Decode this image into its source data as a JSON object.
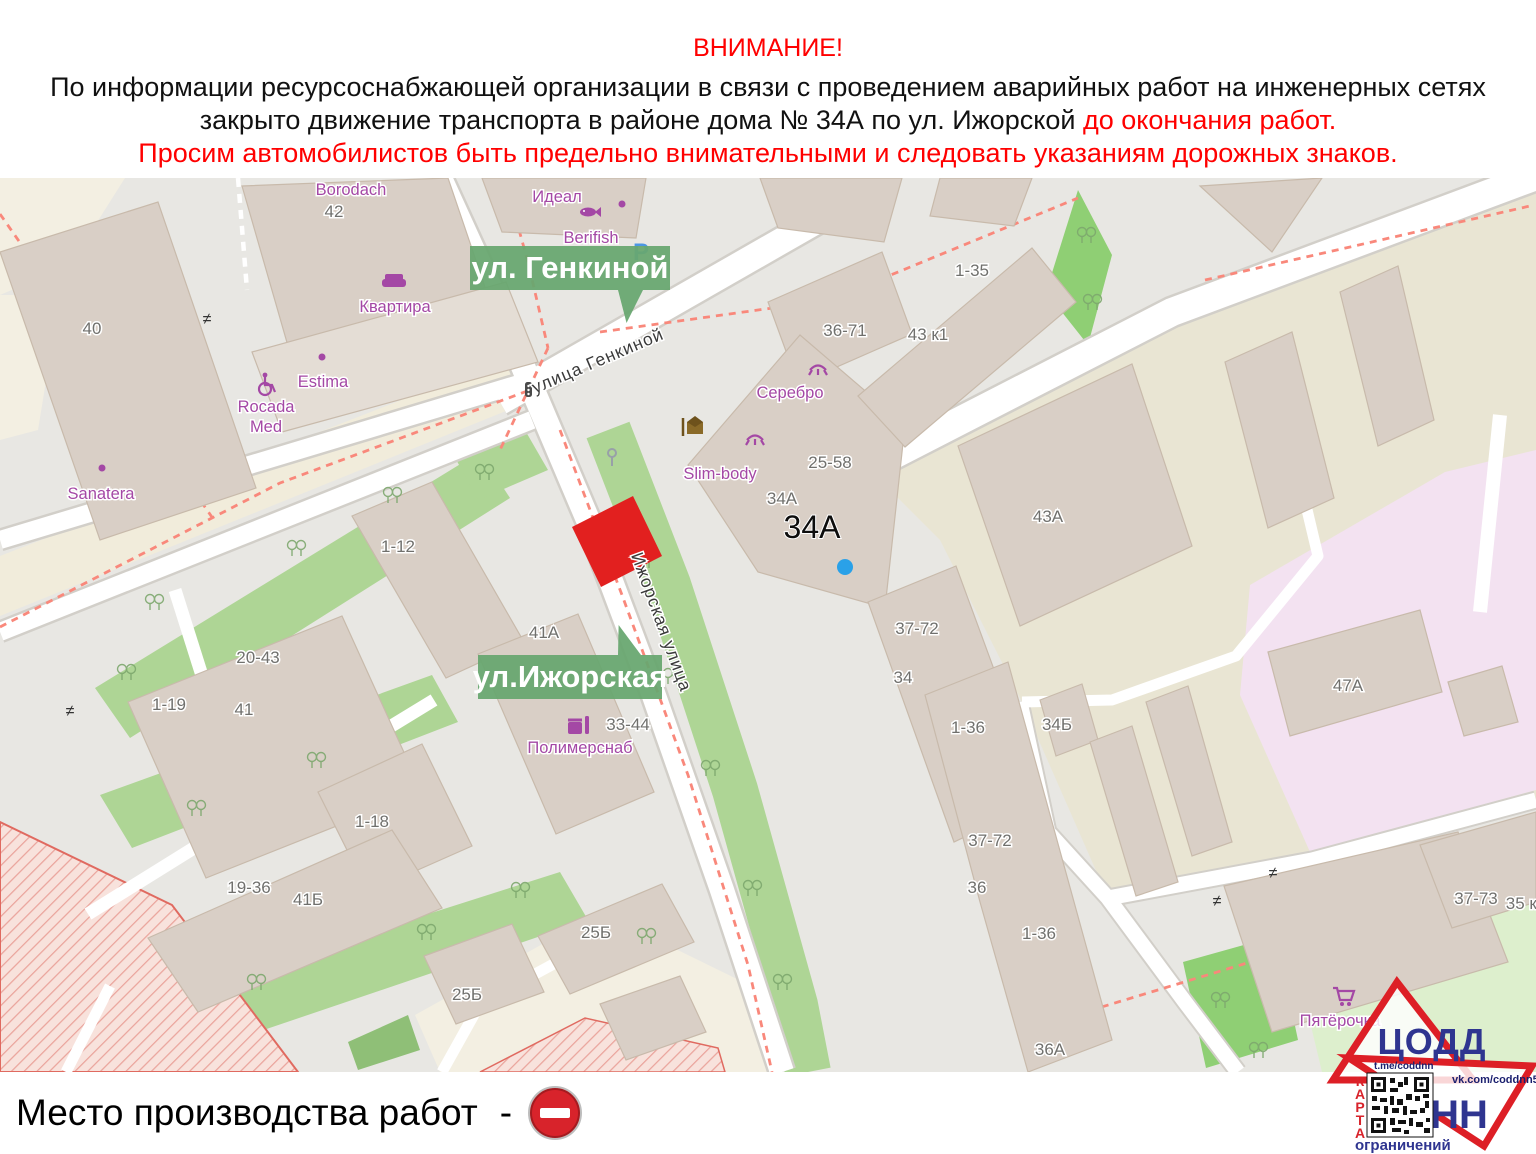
{
  "header": {
    "title": "ВНИМАНИЕ!",
    "line1": "По информации ресурсоснабжающей организации в связи с проведением аварийных работ на инженерных сетях",
    "line2_black": "закрыто движение транспорта в районе дома № 34А по ул. Ижорской",
    "line2_red": "до окончания работ.",
    "line3": "Просим автомобилистов быть предельно внимательными и следовать указаниям дорожных знаков."
  },
  "map": {
    "badges": [
      {
        "label": "ул. Генкиной"
      },
      {
        "label": "ул.Ижорская"
      }
    ],
    "street_labels": [
      {
        "text": "улица Генкиной",
        "x": 600,
        "y": 366,
        "rot": -23
      },
      {
        "text": "Ижорская улица",
        "x": 656,
        "y": 624,
        "rot": 70
      }
    ],
    "highlight": {
      "text": "34А",
      "x": 812,
      "y": 538
    },
    "house_numbers": [
      {
        "t": "40",
        "x": 92,
        "y": 334
      },
      {
        "t": "42",
        "x": 334,
        "y": 217
      },
      {
        "t": "1-35",
        "x": 972,
        "y": 276
      },
      {
        "t": "36-71",
        "x": 845,
        "y": 336
      },
      {
        "t": "43 к1",
        "x": 928,
        "y": 340
      },
      {
        "t": "25-58",
        "x": 830,
        "y": 468
      },
      {
        "t": "34А",
        "x": 782,
        "y": 504
      },
      {
        "t": "43А",
        "x": 1048,
        "y": 522
      },
      {
        "t": "1-12",
        "x": 398,
        "y": 552
      },
      {
        "t": "41А",
        "x": 544,
        "y": 638
      },
      {
        "t": "20-43",
        "x": 258,
        "y": 663
      },
      {
        "t": "1-19",
        "x": 169,
        "y": 710
      },
      {
        "t": "41",
        "x": 244,
        "y": 715
      },
      {
        "t": "33-44",
        "x": 628,
        "y": 730
      },
      {
        "t": "1-36",
        "x": 968,
        "y": 733
      },
      {
        "t": "34Б",
        "x": 1057,
        "y": 730
      },
      {
        "t": "37-72",
        "x": 917,
        "y": 634
      },
      {
        "t": "34",
        "x": 903,
        "y": 683
      },
      {
        "t": "47А",
        "x": 1348,
        "y": 691
      },
      {
        "t": "1-18",
        "x": 372,
        "y": 827
      },
      {
        "t": "37-72",
        "x": 990,
        "y": 846
      },
      {
        "t": "19-36",
        "x": 249,
        "y": 893
      },
      {
        "t": "41Б",
        "x": 308,
        "y": 905
      },
      {
        "t": "36",
        "x": 977,
        "y": 893
      },
      {
        "t": "1-36",
        "x": 1039,
        "y": 939
      },
      {
        "t": "25Б",
        "x": 596,
        "y": 938
      },
      {
        "t": "25Б",
        "x": 467,
        "y": 1000
      },
      {
        "t": "36А",
        "x": 1050,
        "y": 1055
      },
      {
        "t": "37-73",
        "x": 1476,
        "y": 904
      },
      {
        "t": "35 к1",
        "x": 1526,
        "y": 909
      }
    ],
    "poi_labels": [
      {
        "t": "Borodach",
        "x": 351,
        "y": 195
      },
      {
        "t": "Идеал",
        "x": 557,
        "y": 202
      },
      {
        "t": "Berifish",
        "x": 591,
        "y": 243
      },
      {
        "t": "Квартира",
        "x": 395,
        "y": 312
      },
      {
        "t": "Estima",
        "x": 323,
        "y": 387
      },
      {
        "t": "Rocada Med",
        "x": 266,
        "y": 412,
        "wrap": true
      },
      {
        "t": "Sanatera",
        "x": 101,
        "y": 499
      },
      {
        "t": "Серебро",
        "x": 790,
        "y": 398
      },
      {
        "t": "Slim-body",
        "x": 720,
        "y": 479
      },
      {
        "t": "Полимерснаб",
        "x": 580,
        "y": 753
      },
      {
        "t": "Пятёрочка",
        "x": 1340,
        "y": 1026
      }
    ],
    "icon_names": [
      "fish-icon",
      "sofa-icon",
      "wheelchair-icon",
      "eyelash-icon",
      "package-icon",
      "parking-icon",
      "traffic-light-icon",
      "gate-icon",
      "tree-icon",
      "cart-icon",
      "shop-icon",
      "pin-icon",
      "blue-dot-marker",
      "work-site-marker"
    ]
  },
  "legend": {
    "label": "Место производства работ",
    "separator": "-"
  },
  "logo": {
    "org": "ЦОДД",
    "city": "НН",
    "telegram": "t.me/coddnn",
    "vk": "vk.com/coddnn52",
    "map_word": "КАРТА",
    "restrictions_word": "ограничений"
  },
  "colors": {
    "badge_green": "#68a770",
    "marker_red": "#e2201f",
    "no_entry_red": "#d8232b",
    "accent_red": "#ff0000",
    "logo_red": "#dd1f26",
    "logo_blue": "#2f3590",
    "poi_purple": "#a448a5",
    "building_fill": "#d9cfc6",
    "grass": "#aed595",
    "park_green": "#8fcf74",
    "pink_area": "#f3e2f1"
  }
}
